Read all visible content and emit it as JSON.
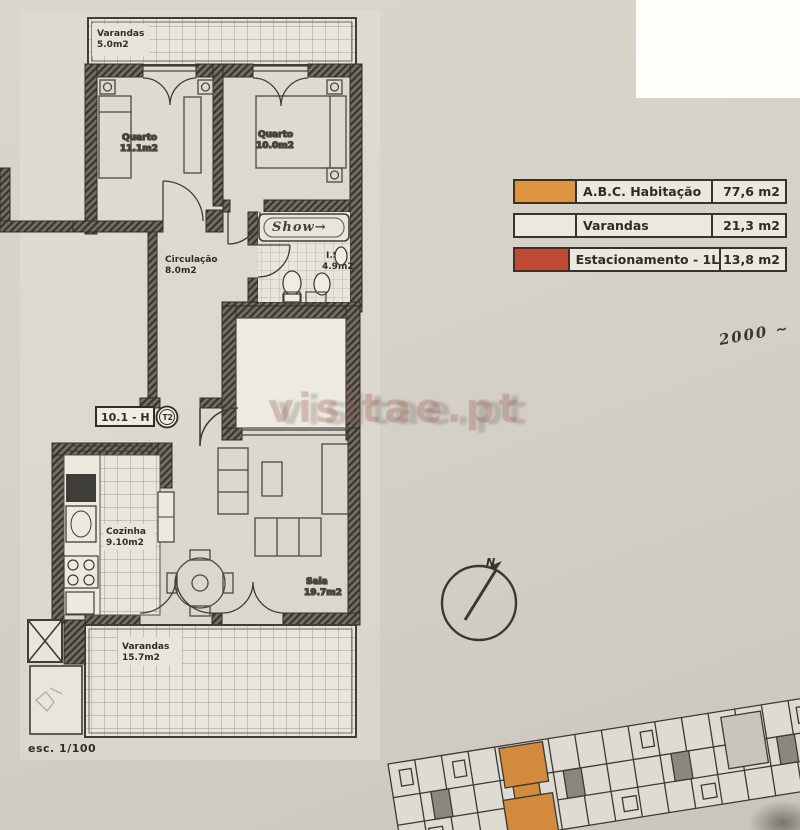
{
  "plan": {
    "unit_code": "10.1 - H",
    "typology": "T2",
    "scale": "esc. 1/100",
    "north": "N"
  },
  "rooms": {
    "balcony_top": {
      "name": "Varandas",
      "area": "5.0m2"
    },
    "bedroom1": {
      "name": "Quarto",
      "area": "11.1m2"
    },
    "bedroom2": {
      "name": "Quarto",
      "area": "10.0m2"
    },
    "hallway": {
      "name": "Circulação",
      "area": "8.0m2"
    },
    "bathroom": {
      "name": "I.S.",
      "area": "4.9m2"
    },
    "kitchen": {
      "name": "Cozinha",
      "area": "9.10m2"
    },
    "living": {
      "name": "Sala",
      "area": "19.7m2"
    },
    "balcony_bottom": {
      "name": "Varandas",
      "area": "15.7m2"
    }
  },
  "legend": {
    "rows": [
      {
        "label": "A.B.C. Habitação",
        "value": "77,6 m2",
        "swatch": "#dd9440"
      },
      {
        "label": "Varandas",
        "value": "21,3 m2",
        "swatch": "#eae8e0"
      },
      {
        "label": "Estacionamento - 1L",
        "value": "13,8 m2",
        "swatch": "#bf4a33"
      }
    ]
  },
  "notes": {
    "handwritten": "2000 ~",
    "bath": "Show→"
  },
  "watermark": {
    "text": "visitae.pt"
  },
  "colors": {
    "paper": "#d6d2c9",
    "ink": "#34322c",
    "highlight_orange": "#dd9440",
    "parking_red": "#bf4a33",
    "balcony_swatch_white": "#eae8e0"
  }
}
